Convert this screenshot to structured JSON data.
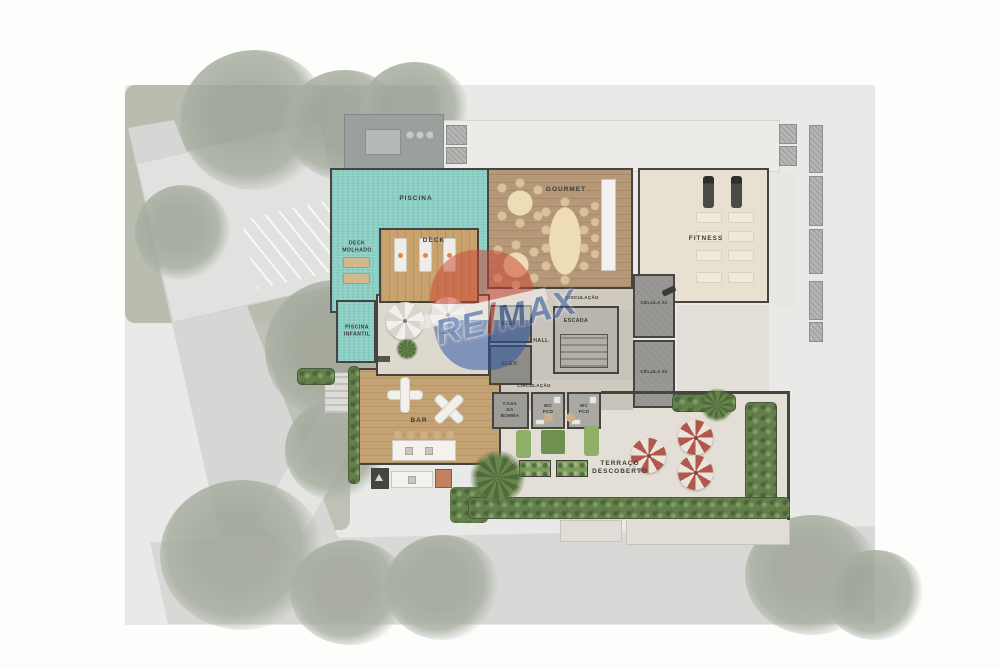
{
  "watermark": {
    "re": "RE",
    "slash": "/",
    "max": "MAX"
  },
  "rooms": {
    "piscina": {
      "label": "PISCINA"
    },
    "deck_molhado": {
      "label": "DECK\nMOLHADO"
    },
    "deck": {
      "label": "DECK"
    },
    "piscina_infantil": {
      "label": "PISCINA\nINFANTIL"
    },
    "gourmet": {
      "label": "GOURMET"
    },
    "fitness": {
      "label": "FITNESS"
    },
    "circulacao_upper": {
      "label": "CIRCULAÇÃO"
    },
    "escada": {
      "label": "ESCADA"
    },
    "elev_top": {
      "label": "ELEV."
    },
    "elev_bottom": {
      "label": "ELEV."
    },
    "hall": {
      "label": "HALL"
    },
    "celula_01": {
      "label": "CÉLULA 01"
    },
    "celula_02": {
      "label": "CÉLULA 02"
    },
    "circulacao_lower": {
      "label": "CIRCULAÇÃO"
    },
    "casa_da_bomba": {
      "label": "CASA\nDA\nBOMBA"
    },
    "wc_pcd_left": {
      "label": "WC\nPCD"
    },
    "wc_pcd_right": {
      "label": "WC\nPCD"
    },
    "bar": {
      "label": "BAR"
    },
    "terraco_descoberto": {
      "label": "TERRAÇO\nDESCOBERTO"
    }
  },
  "palette": {
    "pool_water": "#8bcfc5",
    "wood_deck": "#c9a36f",
    "gourmet_floor": "#b59877",
    "bar_deck": "#c4a274",
    "fitness_floor": "#e8e1d2",
    "stone_terrace": "#e3dfd7",
    "core_gray": "#8e8c86",
    "wall": "#454440",
    "hedge_green": "#647f4b",
    "umbrella_red": "#b2574b",
    "umbrella_white": "#f2f0ec",
    "remax_red": "#cc4534",
    "remax_blue": "#2a55a5"
  }
}
